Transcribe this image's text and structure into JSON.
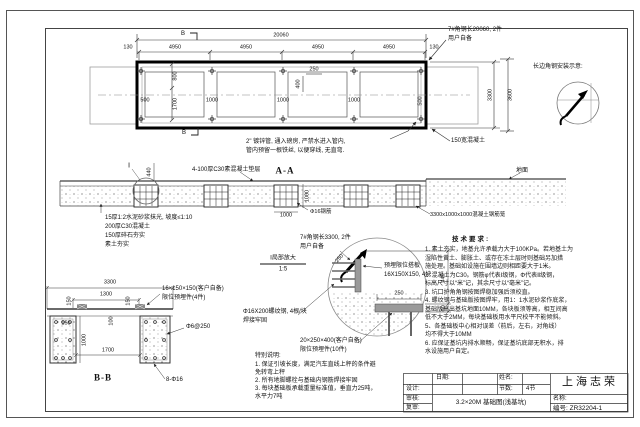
{
  "plan": {
    "section_mark": "B",
    "dim_total": "20060",
    "dim_row2": [
      "130",
      "4950",
      "4950",
      "4950",
      "4950",
      "130"
    ],
    "dim_500_l": "500",
    "dim_800": "800",
    "dim_1700": "1700",
    "dim_1000_a": "1000",
    "dim_1000_b": "1000",
    "dim_1000_c": "1000",
    "dim_400": "400",
    "dim_250": "250",
    "dim_500_r": "500",
    "dim_3300": "3300",
    "dim_3600": "3600",
    "note_angle_l1": "7#角钢长20060, 2件",
    "note_angle_l2": "用户自备",
    "note_edge": "150宽混凝土",
    "note_pipe_l1": "2\" 镀锌管, 通入磅房, 严禁水进入管内,",
    "note_pipe_l2": "管内预留一根铁丝, 以便穿线, 无直弯.",
    "install_label": "长边角钢安装示意:"
  },
  "section_aa": {
    "title": "A-A",
    "detail_mark": "Ⅰ",
    "dim_440": "440",
    "cushion": "4-100厚C30素混凝土垫层",
    "layer1": "15厚1:2水泥砂浆抹光, 坡度≤1:10",
    "layer2": "200厚C30混凝土",
    "layer3": "150厚碎石夯实",
    "layer4": "素土夯实",
    "ground": "地面",
    "rebar": "Φ16钢筋",
    "cage": "3300x1000x1000混凝土钢筋笼",
    "dim_1000_v": "1000",
    "dim_1000_h": "1000",
    "detail_name": "Ⅰ局部放大",
    "detail_scale": "1:5"
  },
  "detail": {
    "note_angle_l1": "7#角钢长3300, 2件",
    "note_angle_l2": "用户自备",
    "dim_250_diag": "250",
    "plate_l1": "预埋限位搭板",
    "plate_l2": "16X150X150, 4块",
    "dim_250": "250",
    "dim_440": "440",
    "dim_50": "50",
    "rebar_l1": "Φ16X200螺纹钢, 4根/块",
    "rebar_l2": "焊接牢固",
    "embed_l1": "20×250×400(客户自备)",
    "embed_l2": "限位预埋件(10件)"
  },
  "section_bb": {
    "title": "B-B",
    "dim_3300": "3300",
    "dim_1300": "1300",
    "dim_150_a": "150",
    "dim_150_b": "150",
    "dim_150_c": "150",
    "dim_100": "100",
    "dim_1000": "1000",
    "dim_1700": "1700",
    "embed_l1": "16×150×150(客户自备)",
    "embed_l2": "限位预埋件(4件)",
    "stirrup": "Φ6@250",
    "rebar": "8-Φ16"
  },
  "tech": {
    "title": "技术要求:",
    "lines": [
      "1. 素土夯实，地基允许承载力大于100KPa。若地基土为",
      "湿陷性黄土、膨胀土、或存在冻土层时则基础另加措",
      "施处理。基础如设施在围墙边则相距要大于1米。",
      "2. 混凝土为C30。钢筋φ代表Ⅰ级钢，Φ代表Ⅱ级钢，",
      "标高尺寸以“米”记，其余尺寸以“毫米”记。",
      "3. 坑口护角角钢按图焊稳加强后须校直。",
      "4. 螺纹钢与基础版按图焊牢，用1：1水泥砂浆作底浆，",
      "基础版高出基坑地面10MM，各块板须等高，相互间高",
      "低不大于2MM，每块基础板用水平尺校平不能倾斜。",
      "5、各基础板中心相对误差（前后，左右，对角线）",
      "均不得大于10MM",
      "6. 应保证基坑内排水顺畅，保证基坑底部无积水，排",
      "水设施用户自定。"
    ]
  },
  "notes": {
    "title": "特别说明:",
    "lines": [
      "1. 保证引坡长度，满足汽车直线上秤的条件避",
      "免转弯上秤",
      "2. 所有地脚螺栓与基础内钢筋焊接牢固",
      "3. 每块基础板承载重量标准值，垂直力25吨，",
      "水平力7吨"
    ]
  },
  "titleblock": {
    "date": "日期:",
    "name": "姓名:",
    "design": "设计:",
    "sections": "节数:",
    "sections_val": "4节",
    "review": "审核:",
    "recheck": "复审:",
    "drawing": "3.2×20M 基础图(浅基坑)",
    "company": "上海志荣",
    "name_lbl": "名称:",
    "number": "编号: ZR32204-1"
  }
}
